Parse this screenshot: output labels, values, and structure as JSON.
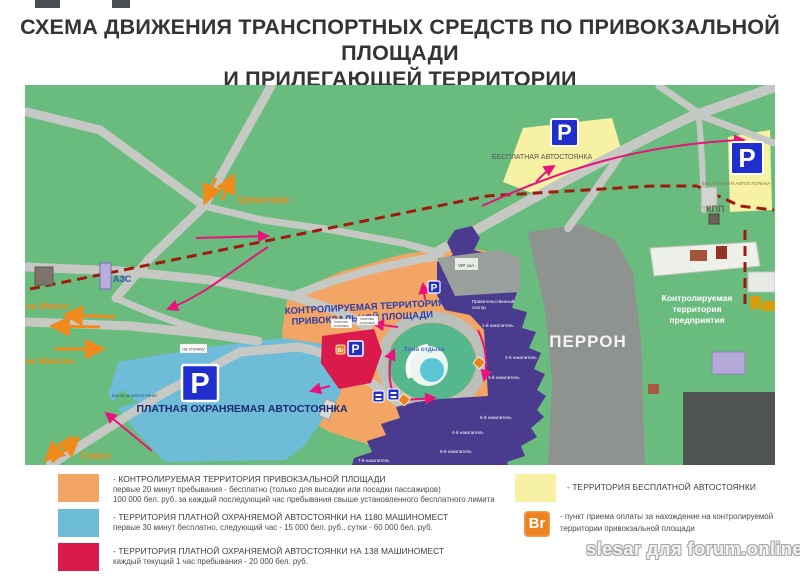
{
  "header": {
    "title_line1": "СХЕМА ДВИЖЕНИЯ ТРАНСПОРТНЫХ СРЕДСТВ ПО ПРИВОКЗАЛЬНОЙ ПЛОЩАДИ",
    "title_line2": "И ПРИЛЕГАЮЩЕЙ ТЕРРИТОРИИ"
  },
  "map": {
    "colors": {
      "ground": "#6abc7e",
      "road": "#c6c9c3",
      "controlled_zone": "#f2a565",
      "paid_parking_zone": "#6fbcd9",
      "paid_parking_138_zone": "#da1a4b",
      "free_parking_zone": "#f7f1a3",
      "station_building": "#4a3b8f",
      "perron": "#8f9390",
      "boundary_dashed": "#9e1b0e",
      "arrow_pink": "#e8137b",
      "arrow_orange": "#f08a1c",
      "p_sign": "#1f2ecc",
      "br_point": "#ee8220"
    },
    "labels": {
      "free_parking_1": "БЕСПЛАТНАЯ АВТОСТОЯНКА",
      "free_parking_2": "БЕСПЛАТНАЯ АВТОСТОЯНКА",
      "paid_parking": "ПЛАТНАЯ ОХРАНЯЕМАЯ АВТОСТОЯНКА",
      "controlled_area_line1": "КОНТРОЛИРУЕМАЯ ТЕРРИТОРИЯ",
      "controlled_area_line2": "ПРИВОКЗАЛЬНОЙ ПЛОЩАДИ",
      "perron": "ПЕРРОН",
      "enterprise_line1": "Контролируемая",
      "enterprise_line2": "территория",
      "enterprise_line3": "предприятия",
      "rest_zone": "Зона отдыха",
      "vip_hall": "VIP зал",
      "gov_line1": "Правительственный",
      "gov_line2": "сектор",
      "kpp": "КПП",
      "azs": "АЗС",
      "to_minsk": "на Минск",
      "from_minsk": "из Минска",
      "sokol": "Сокол",
      "shemetovo": "Шеметово",
      "stop1_line1": "Конечная",
      "stop1_line2": "остановка",
      "stop2_line1": "Конечная",
      "stop2_line2": "остановка",
      "to_parking_sign": "на стоянку",
      "parking_entry_sign": "ВЪЕЗД НА АВТОСТОЯНКУ",
      "p_letter": "P",
      "br": "Br",
      "nakopitel_1": "1-й накопитель",
      "nakopitel_2": "2-й накопитель",
      "nakopitel_3": "3-й накопитель",
      "nakopitel_4": "4-й накопитель",
      "nakopitel_5": "5-й накопитель",
      "nakopitel_6": "6-й накопитель",
      "nakopitel_7": "7-й накопитель"
    }
  },
  "legend": {
    "items": [
      {
        "color": "#f2a565",
        "title": "- КОНТРОЛИРУЕМАЯ ТЕРРИТОРИЯ ПРИВОКЗАЛЬНОЙ ПЛОЩАДИ",
        "line2": "первые 20 минут пребывания - бесплатно (только для высадки или посадки пассажиров)",
        "line3": "100 000 бел. руб. за каждый последующий час пребывания свыше установленного бесплатного лимита"
      },
      {
        "color": "#6fbcd9",
        "title": "- ТЕРРИТОРИЯ ПЛАТНОЙ ОХРАНЯЕМОЙ АВТОСТОЯНКИ НА 1180 МАШИНОМЕСТ",
        "line2": "первые 30 минут бесплатно, следующий час - 15 000 бел. руб., сутки - 60 000 бел. руб."
      },
      {
        "color": "#da1a4b",
        "title": "- ТЕРРИТОРИЯ ПЛАТНОЙ ОХРАНЯЕМОЙ АВТОСТОЯНКИ НА 138 МАШИНОМЕСТ",
        "line2": "каждый текущий 1 час пребывания - 20 000 бел. руб."
      },
      {
        "color": "#f7f1a3",
        "title": "- ТЕРРИТОРИЯ БЕСПЛАТНОЙ АВТОСТОЯНКИ"
      }
    ],
    "br_item": {
      "icon": "Br",
      "line1": "- пункт приема оплаты за нахождение на контролируемой",
      "line2": "территории привокзальной площади"
    }
  },
  "watermark": "slesar для forum.onliner.by"
}
